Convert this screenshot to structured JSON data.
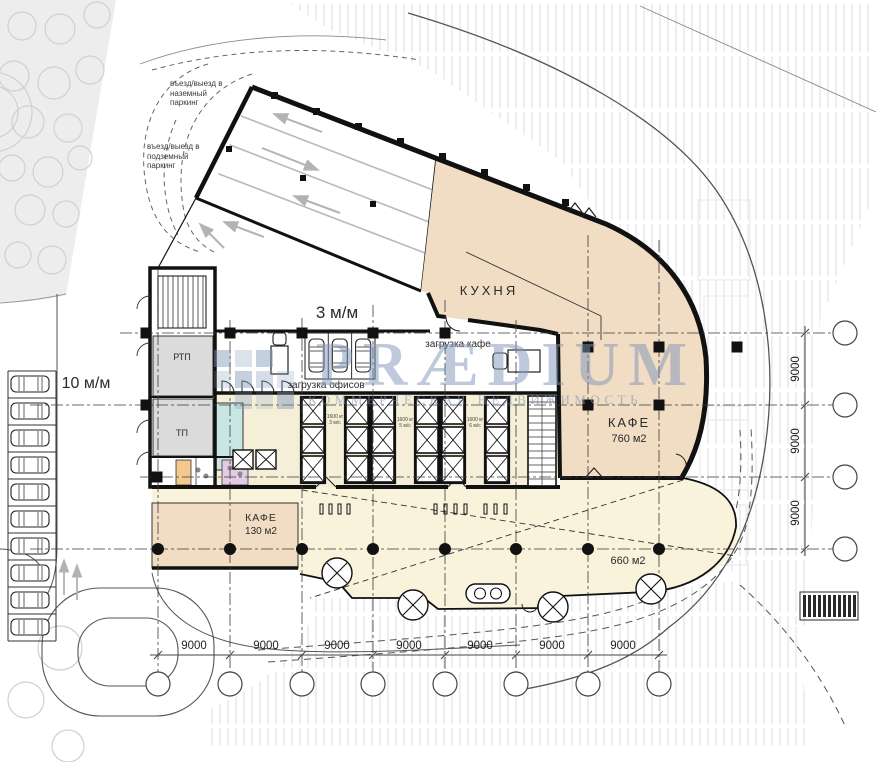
{
  "watermark": {
    "logo": "PRÆDIUM",
    "tagline": "КОММЕРЧЕСКАЯ НЕДВИЖИМОСТЬ"
  },
  "annotations": {
    "surface_parking_entry": "въезд/выезд в\nназемный\nпаркинг",
    "underground_parking_entry": "въезд/выезд в\nподземный\nпаркинг",
    "parking_spaces_3": "3 м/м",
    "parking_spaces_10": "10 м/м",
    "cafe_loading": "загрузка кафе",
    "office_loading": "загрузка офисов"
  },
  "rooms": {
    "kitchen": "КУХНЯ",
    "cafe_main_name": "КАФЕ",
    "cafe_main_area": "760 м2",
    "cafe_small_name": "КАФЕ",
    "cafe_small_area": "130 м2",
    "hall_area": "660 м2",
    "rtp": "РТП",
    "tp": "ТП"
  },
  "elevators": [
    {
      "capacity": "1600 кг",
      "speed": "3 м/с"
    },
    {
      "capacity": "1600 кг",
      "speed": "5 м/с"
    },
    {
      "capacity": "1600 кг",
      "speed": "6 м/с"
    }
  ],
  "dimensions": {
    "bottom": [
      "9000",
      "9000",
      "9000",
      "9000",
      "9000",
      "9000",
      "9000"
    ],
    "right": [
      "9000",
      "9000",
      "9000"
    ]
  },
  "colors": {
    "cafe_fill": "#f1dcc4",
    "hall_fill": "#f8f3da",
    "core_fill": "#f5efd8",
    "tech_room_fill": "#dbdbdb",
    "wet_room_teal": "#c9e6e2",
    "wet_room_orange": "#f3c98e",
    "wet_room_pink": "#e3cbe3",
    "greenery": "#ededed",
    "hatch": "#dcdcdc",
    "line": "#1a1a1a",
    "watermark": "#7e96b8"
  }
}
